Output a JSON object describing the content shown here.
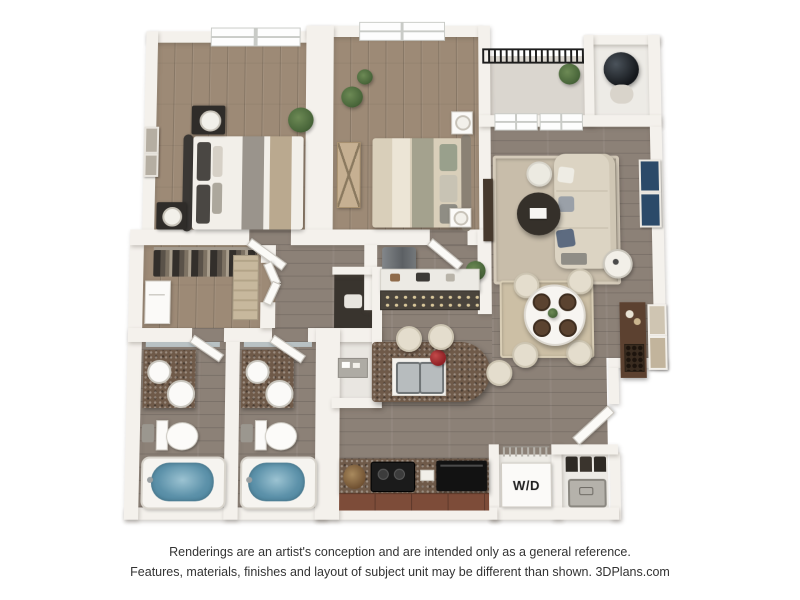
{
  "footer": {
    "line1": "Renderings are an artist's conception and are intended only as a general reference.",
    "line2": "Features, materials, finishes and layout of subject unit may be different than shown.",
    "brand": "3DPlans.com"
  },
  "labels": {
    "washer_dryer": "W/D"
  },
  "colors": {
    "wall": "#f4f1ec",
    "wood_warm": "#9d8a76",
    "wood_gray": "#8c8177",
    "granite": "#6f5a49",
    "water": "#5d92aa",
    "sofa": "#dcd4c3",
    "rug_living": "#c8bdaa",
    "rug_dining": "#ccbfa5",
    "cabinet_brown": "#7d4c39",
    "railing": "#1d1d1d",
    "navy_art": "#2b4a69",
    "greenery": "#49663a"
  }
}
